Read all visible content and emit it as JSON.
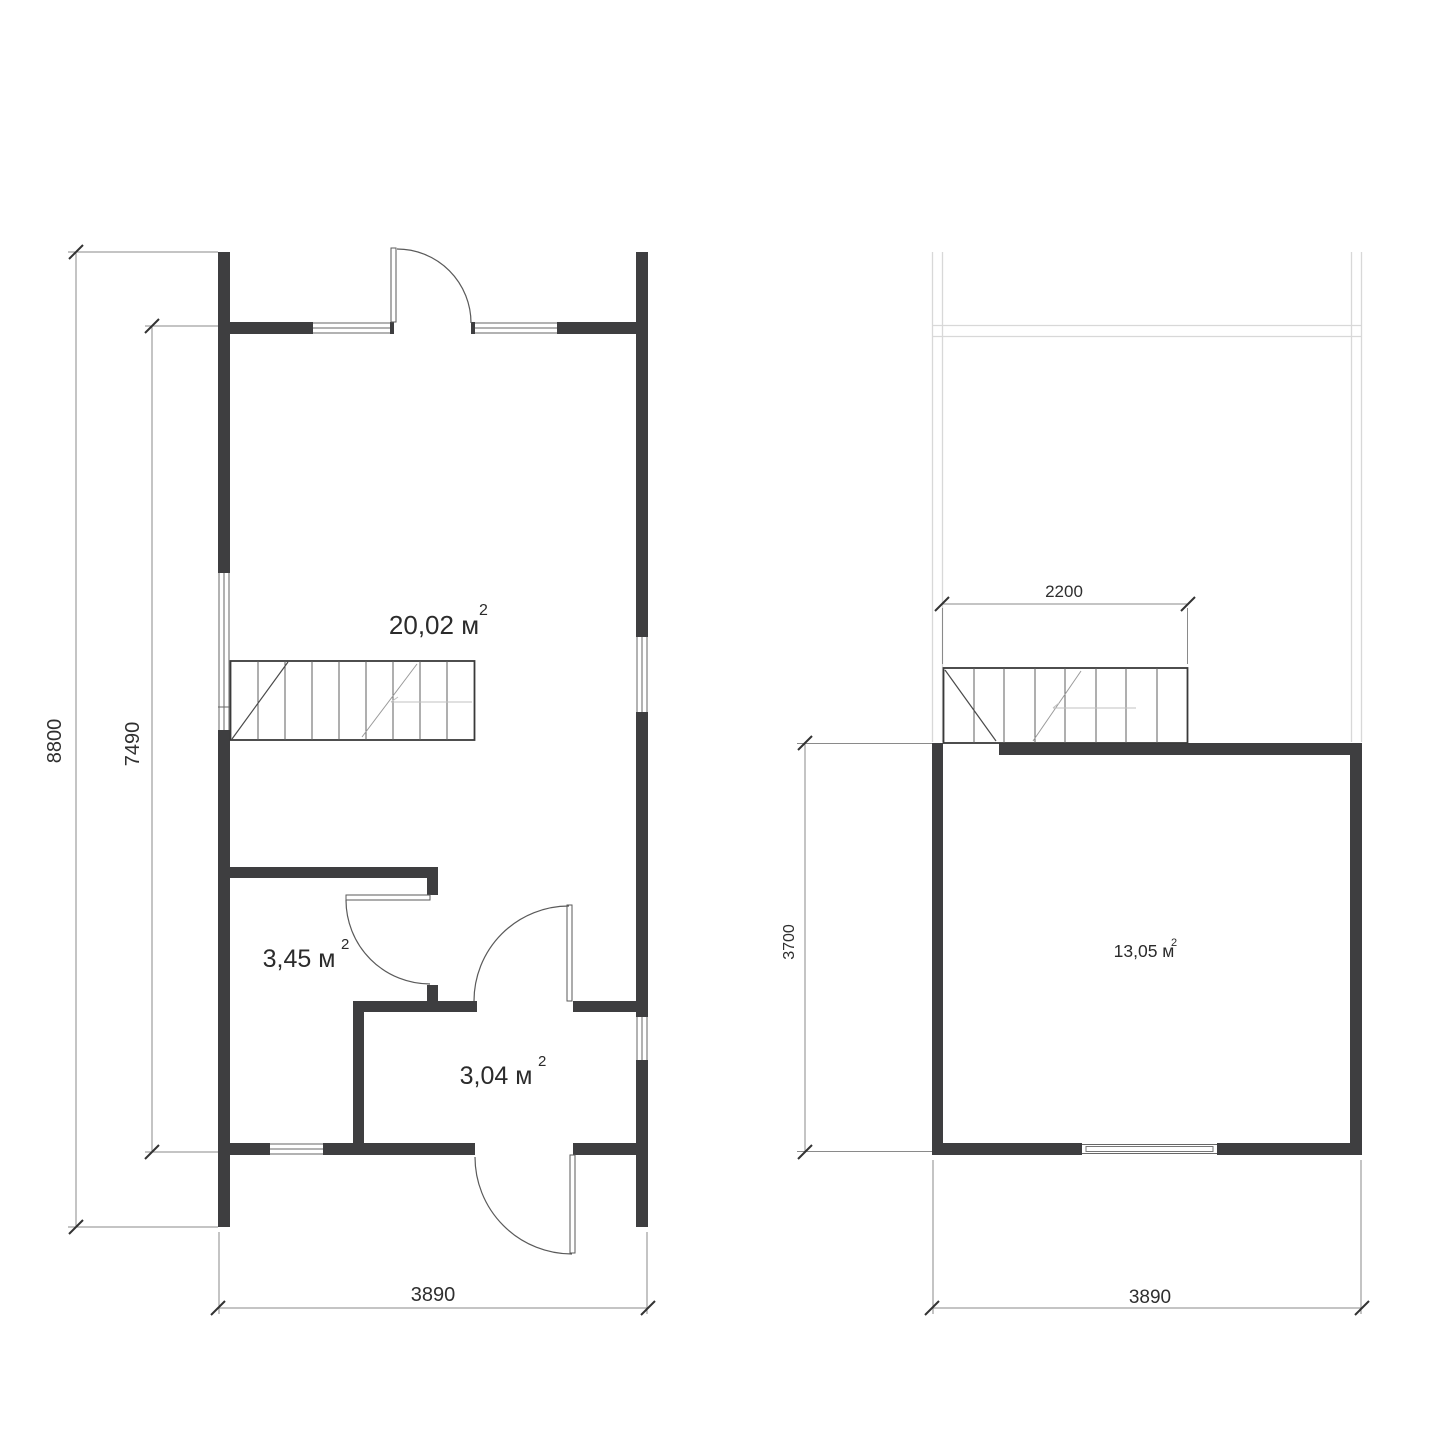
{
  "drawing": {
    "type": "floor-plan",
    "colors": {
      "wall": "#3e3e40",
      "thin_line": "#5a5a5a",
      "dimension_line": "#8a8a8a",
      "lower_floor_outline": "#d8d8d8",
      "text": "#2b2b2b",
      "background": "#ffffff"
    },
    "ground_floor": {
      "rooms": [
        {
          "id": "main-room",
          "area": "20,02 м",
          "sup": "2"
        },
        {
          "id": "small-room",
          "area": "3,45 м",
          "sup": "2"
        },
        {
          "id": "entry-room",
          "area": "3,04 м",
          "sup": "2"
        }
      ],
      "dimensions": {
        "height_total": "8800",
        "height_inner": "7490",
        "width": "3890"
      }
    },
    "upper_floor": {
      "rooms": [
        {
          "id": "upper-room",
          "area": "13,05 м",
          "sup": "2"
        }
      ],
      "dimensions": {
        "stair_width": "2200",
        "room_depth": "3700",
        "width": "3890"
      }
    }
  }
}
